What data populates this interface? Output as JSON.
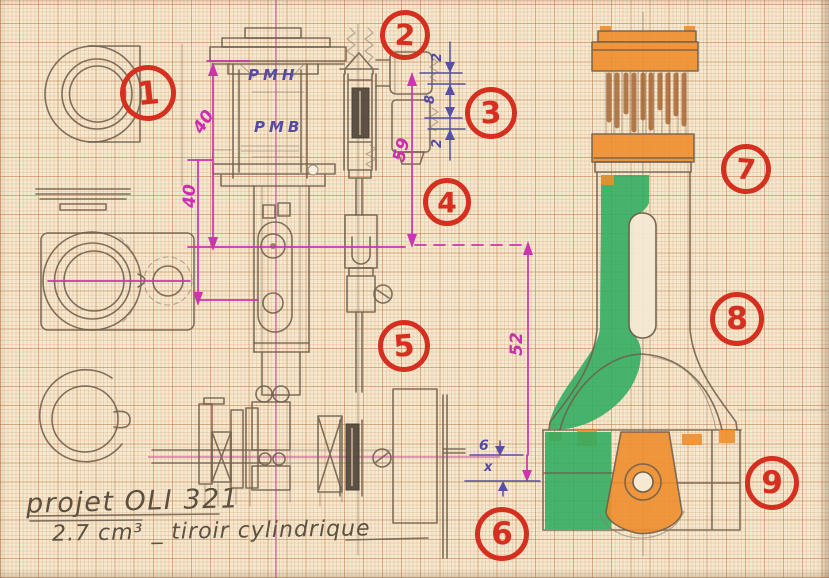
{
  "document": {
    "kind": "hand-drawn engine design sketch on millimeter graph paper"
  },
  "title_block": {
    "line1": "projet OLI 321",
    "line2": "2.7 cm³ _  tiroir cylindrique"
  },
  "labels": {
    "pmh": "PMH",
    "pmb": "PMB"
  },
  "dimensions": {
    "d40a": "40",
    "d40b": "40",
    "d59": "59",
    "d52": "52",
    "d2a": "2",
    "d8": "8",
    "d2b": "2",
    "d6": "6",
    "dx": "x"
  },
  "callouts": [
    {
      "label": "1"
    },
    {
      "label": "2"
    },
    {
      "label": "3"
    },
    {
      "label": "4"
    },
    {
      "label": "5"
    },
    {
      "label": "6"
    },
    {
      "label": "7"
    },
    {
      "label": "8"
    },
    {
      "label": "9"
    }
  ],
  "colors": {
    "paper": "#f5e9d2",
    "grid": "#c9824f",
    "pencil": "#6f5f4c",
    "ink_magenta": "#cb35ad",
    "ink_purple": "#584fa2",
    "centerline_crimson": "#c23a8c",
    "marker_red": "#d5301f",
    "marker_orange": "#ee8e2e",
    "marker_green": "#2fac60",
    "marker_brown": "#a3602c"
  }
}
